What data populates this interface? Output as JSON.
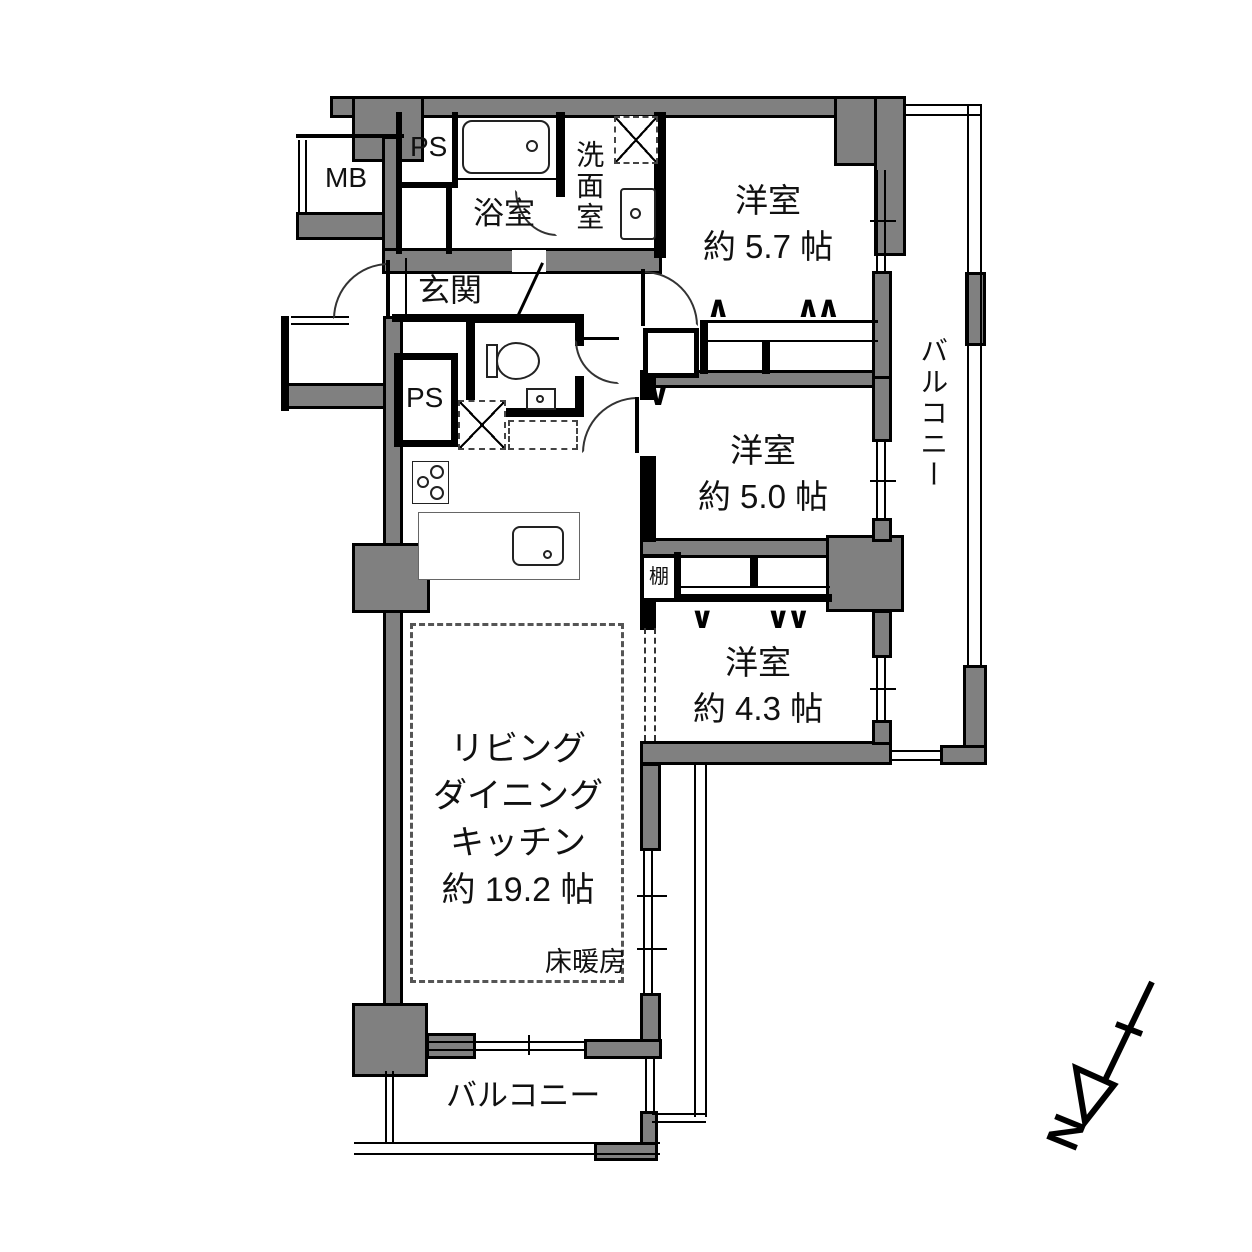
{
  "plan_type": "apartment-floor-plan",
  "labels": {
    "mb": "MB",
    "ps": "PS",
    "bath": "浴室",
    "washroom": "洗面室",
    "entrance": "玄関",
    "shelf": "棚",
    "floor_heating": "床暖房",
    "balcony_right": "バルコニー",
    "balcony_bottom": "バルコニー",
    "north": "N"
  },
  "rooms": [
    {
      "name": "洋室",
      "size": "約 5.7 帖"
    },
    {
      "name": "洋室",
      "size": "約 5.0 帖"
    },
    {
      "name": "洋室",
      "size": "約 4.3 帖"
    }
  ],
  "ldk": {
    "line1": "リビング",
    "line2": "ダイニング",
    "line3": "キッチン",
    "size": "約 19.2 帖"
  },
  "hanger_marks": {
    "single_up": "∧",
    "double_up": "∧∧",
    "single_down": "∨",
    "double_down": "∨∨"
  },
  "colors": {
    "wall": "#808080",
    "line": "#000000",
    "bg": "#ffffff"
  }
}
